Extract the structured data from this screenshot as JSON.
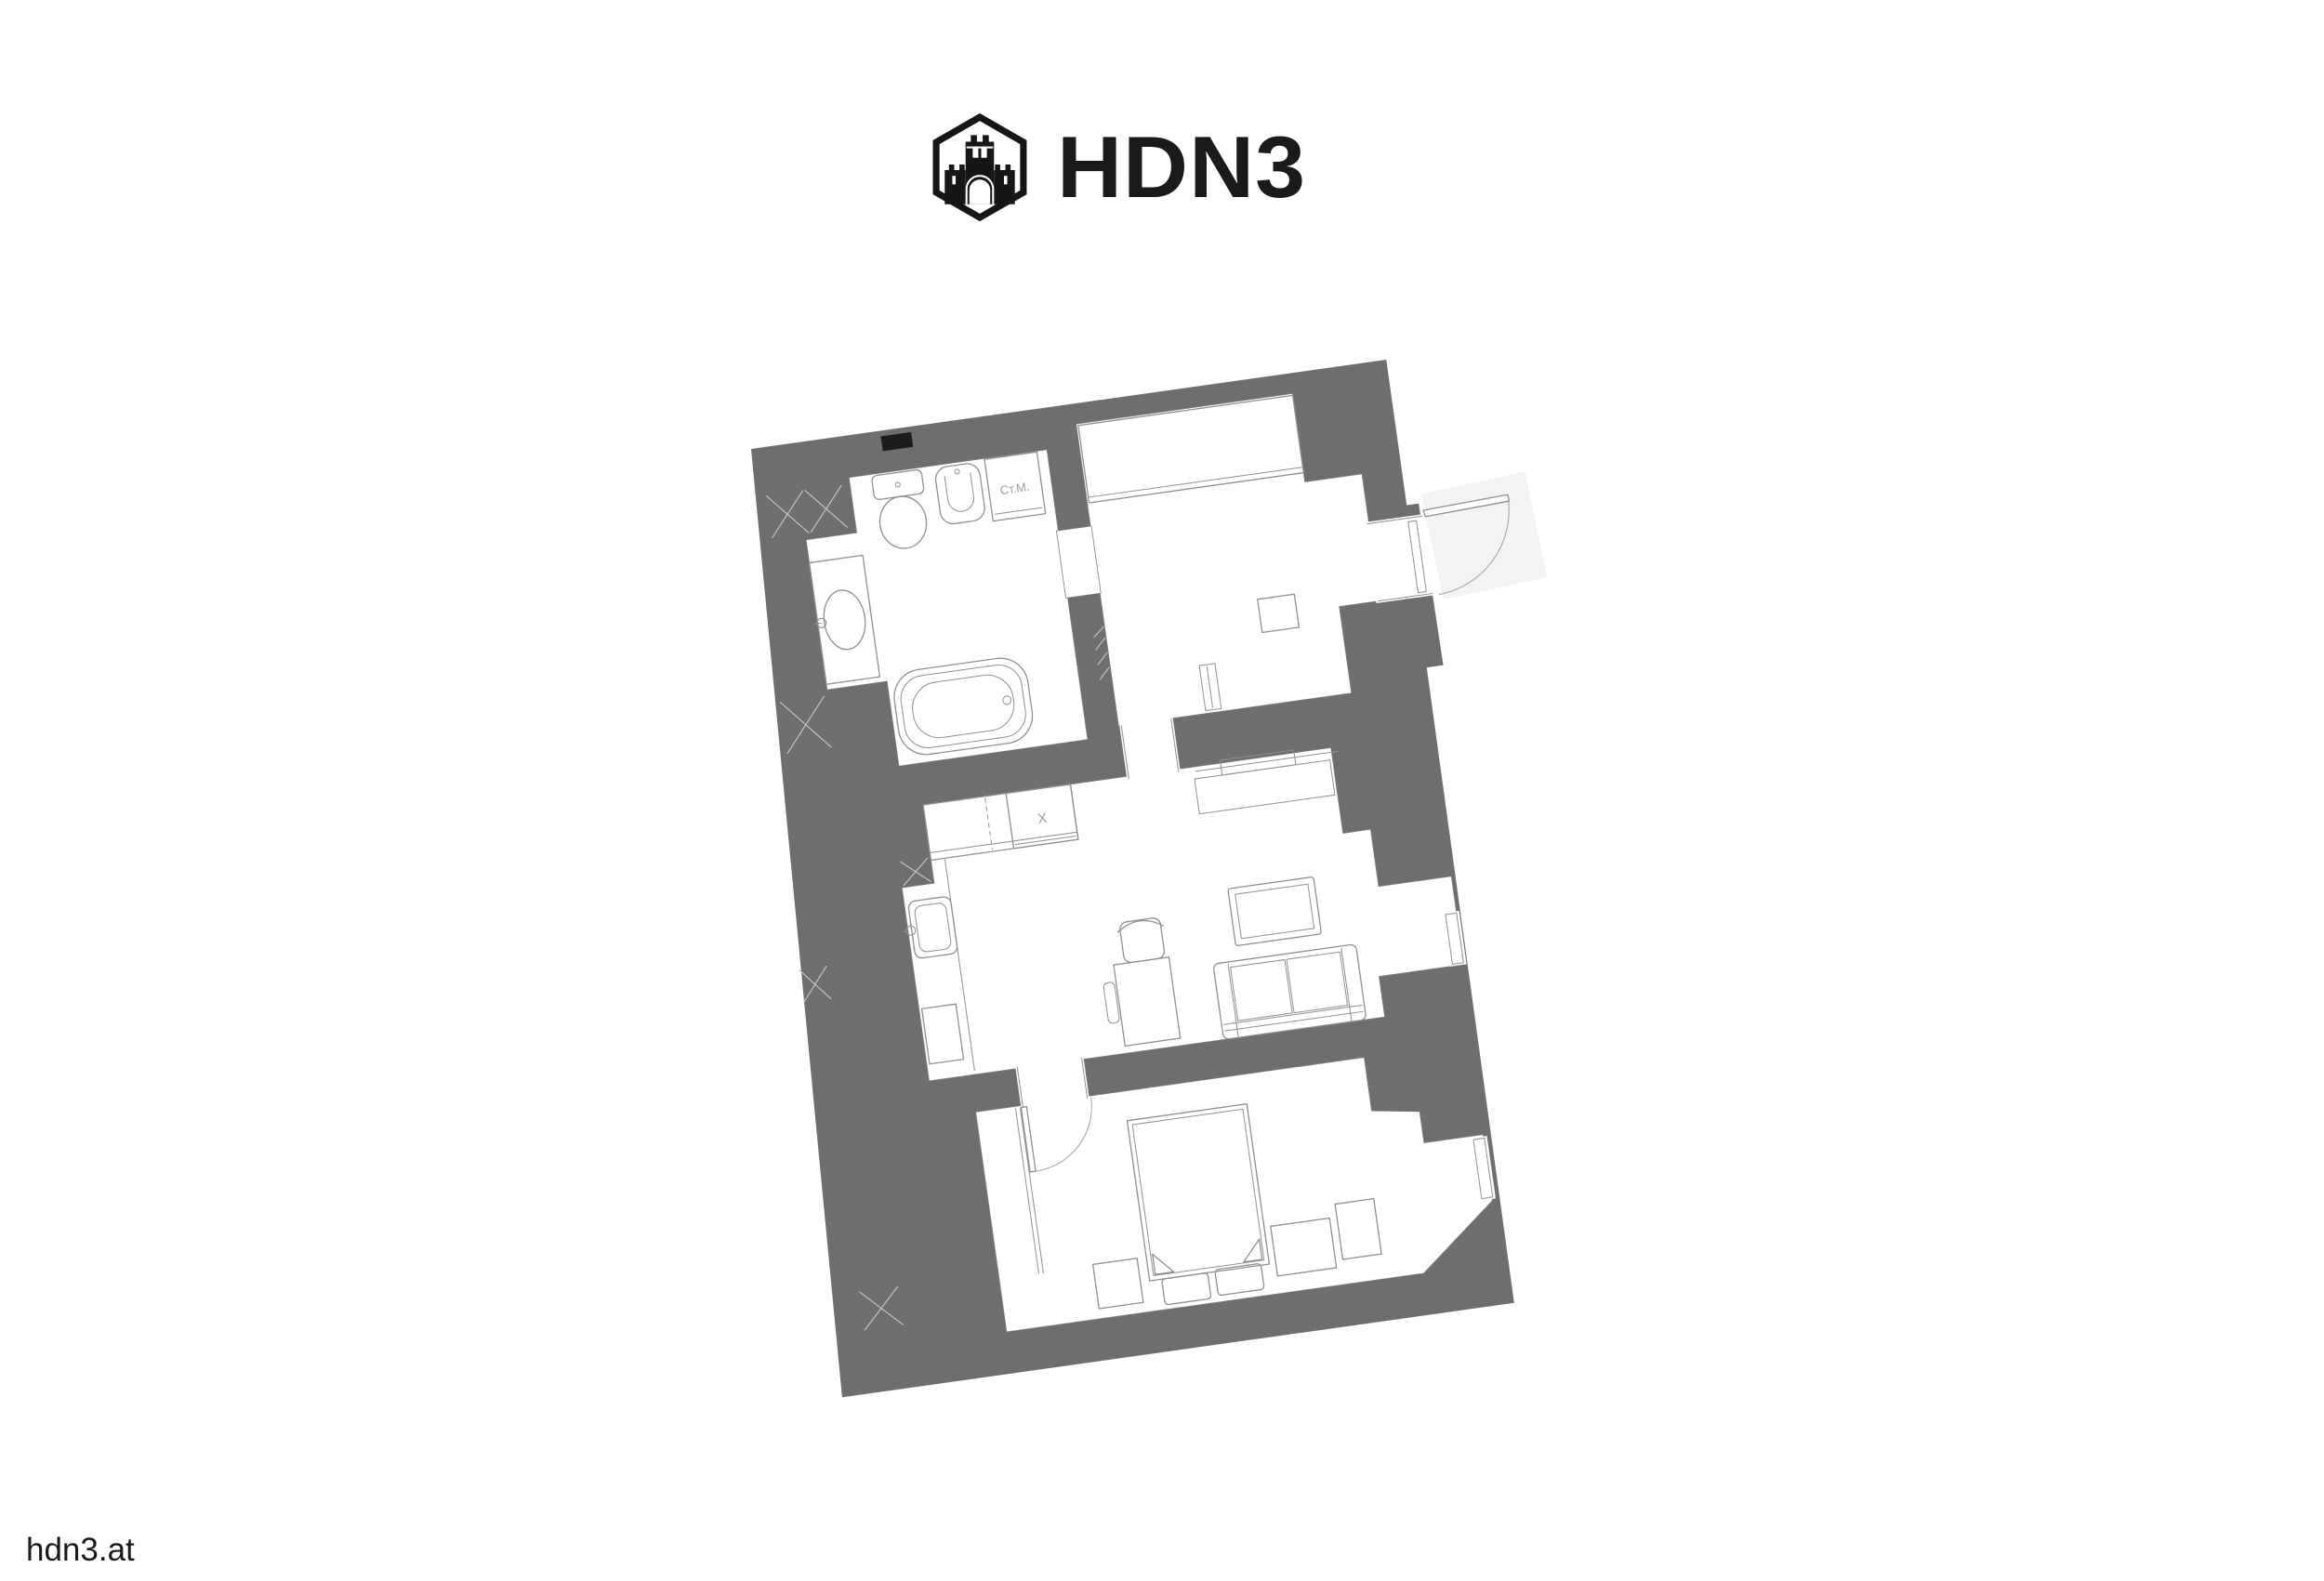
{
  "logo": {
    "brand": "HDN3",
    "icon": "castle-hexagon"
  },
  "floor_plan": {
    "labels": {
      "washing_machine": "Ст.М.",
      "hob": "X"
    },
    "rotation_deg": -8,
    "colors": {
      "wall": "#6e6e6e",
      "line": "#8f8f8f",
      "edge": "#7d7d7d",
      "hatch": "#c4c4c4",
      "label": "#9c9c9c",
      "marker": "#1c1c1c",
      "landing": "#f3f3f3",
      "ink": "#1a1a1a"
    },
    "fixtures": [
      "toilet",
      "bidet",
      "washing-machine",
      "vanity-sink",
      "bathtub",
      "wardrobe",
      "nightstand",
      "radiator",
      "entrance-door",
      "interior-door",
      "kitchen-counter",
      "hob",
      "kitchen-sink",
      "kitchen-unit",
      "desk",
      "desk-chair",
      "tv",
      "sofa",
      "sideboard",
      "double-bed",
      "pillow",
      "dresser",
      "window",
      "wall-hatch"
    ]
  },
  "footer": {
    "site_label": "hdn3.at"
  }
}
